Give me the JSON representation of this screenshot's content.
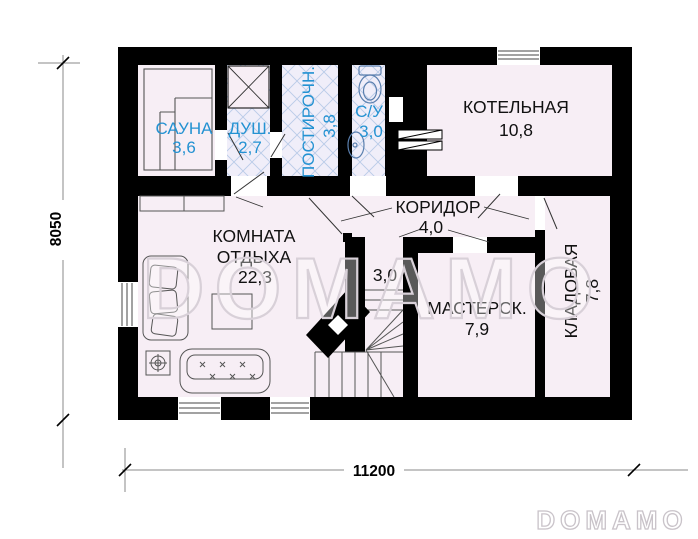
{
  "plan": {
    "watermark_center": "DOMAMO",
    "watermark_corner": "DOMAMO",
    "dimensions": {
      "height_mm": "8050",
      "width_mm": "11200"
    },
    "rooms": {
      "sauna": {
        "name": "САУНА",
        "area": "3,6"
      },
      "shower": {
        "name": "ДУШ.",
        "area": "2,7"
      },
      "laundry": {
        "name": "ПОСТИРОЧН.",
        "area": "3,8"
      },
      "wc": {
        "name": "С/У",
        "area": "3,0"
      },
      "boiler": {
        "name": "КОТЕЛЬНАЯ",
        "area": "10,8"
      },
      "corridor": {
        "name": "КОРИДОР",
        "area": "4,0"
      },
      "lounge": {
        "name_line1": "КОМНАТА",
        "name_line2": "ОТДЫХА",
        "area": "22,3"
      },
      "stair_hall": {
        "area": "3,0"
      },
      "workshop": {
        "name": "МАСТЕРСК.",
        "area": "7,9"
      },
      "storage": {
        "name": "КЛАДОВАЯ",
        "area": "7,8"
      }
    },
    "colors": {
      "wall": "#000000",
      "room_fill": "#f7eef5",
      "tile_fill": "#f0eef9",
      "tile_line": "#b9cbe8",
      "wet_room_label": "#2492d2",
      "label": "#111111"
    }
  }
}
